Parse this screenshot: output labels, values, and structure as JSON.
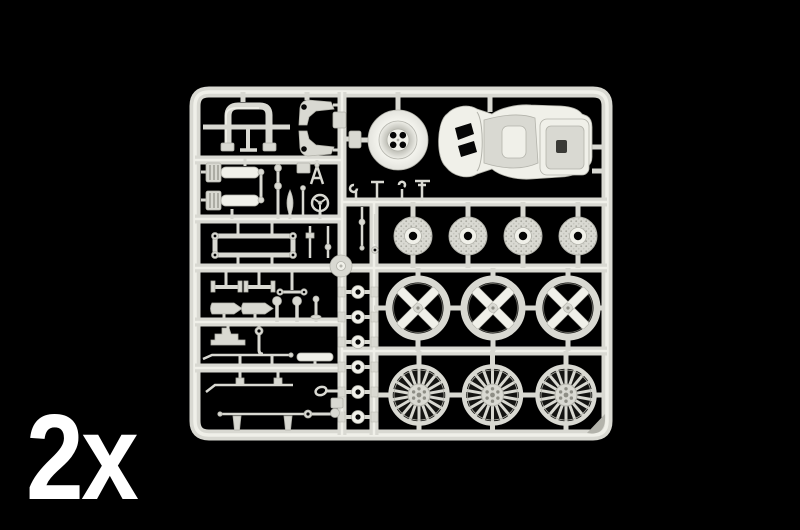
{
  "image": {
    "description": "Photo of a light-grey plastic model kit parts sprue on a black background"
  },
  "label": {
    "quantity": "2x"
  },
  "colors": {
    "background": "#000000",
    "plastic": "#d9d9d2",
    "plastic_light": "#f0f0e9",
    "plastic_dark": "#b3b3ab",
    "plastic_shadow": "#8e8e86",
    "wheel_gap": "#141412",
    "hole": "#060606",
    "label_text": "#ffffff"
  },
  "parts": {
    "racing_seat": {
      "count": 1
    },
    "wheel_dish": {
      "count": 1
    },
    "roll_bar": {
      "count": 1
    },
    "brake_discs": {
      "count": 4
    },
    "cross_spoke_rims": {
      "count": 3
    },
    "turbofan_wheels": {
      "count": 3,
      "spokes": 18
    },
    "washers": {
      "count": 6
    }
  }
}
